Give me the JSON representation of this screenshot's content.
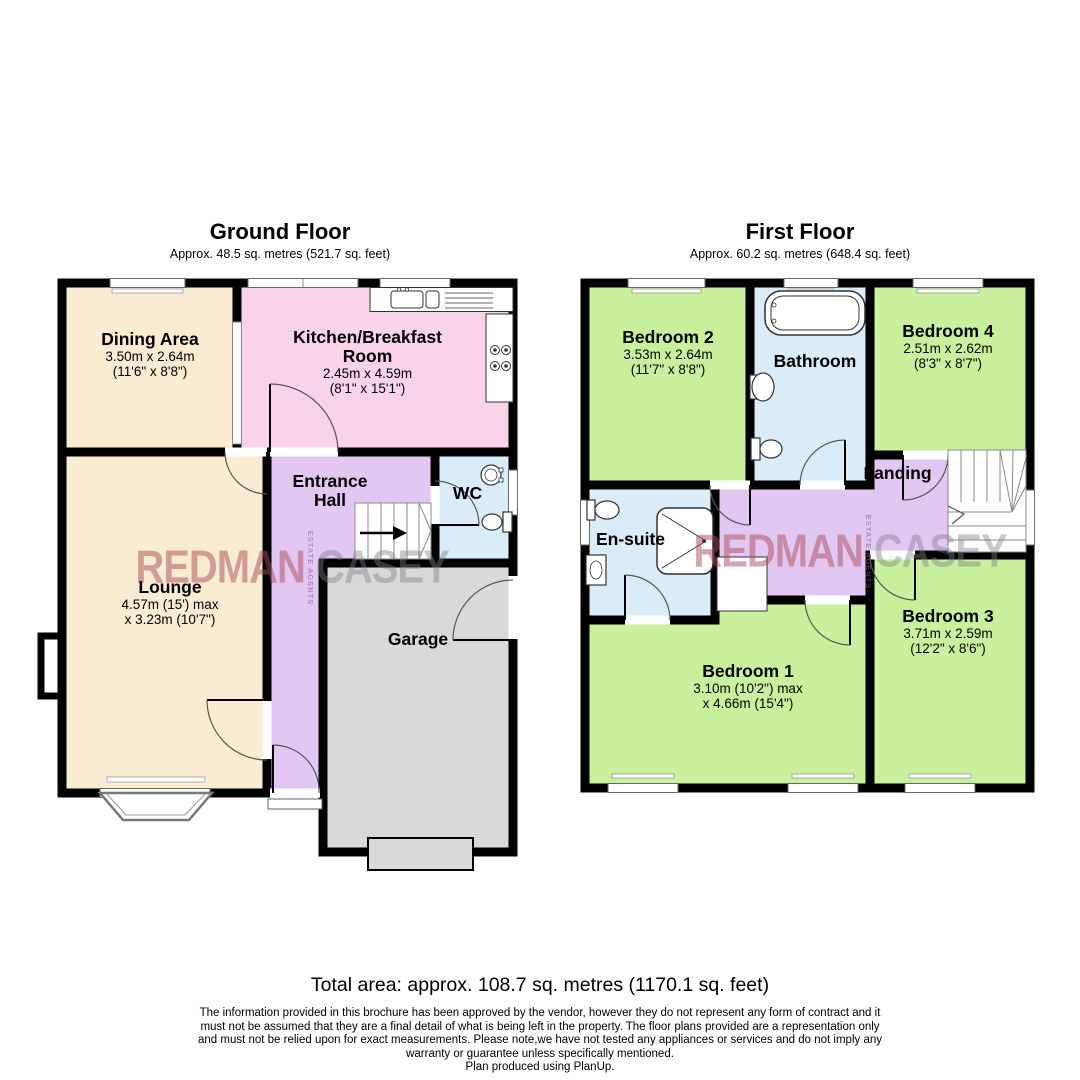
{
  "ground_floor": {
    "title": "Ground Floor",
    "subtitle": "Approx. 48.5 sq. metres (521.7 sq. feet)",
    "rooms": {
      "dining": {
        "name": "Dining Area",
        "dims1": "3.50m x 2.64m",
        "dims2": "(11'6\" x 8'8\")"
      },
      "kitchen": {
        "name": "Kitchen/Breakfast Room",
        "dims1": "2.45m x 4.59m",
        "dims2": "(8'1\" x 15'1\")"
      },
      "lounge": {
        "name": "Lounge",
        "dims1": "4.57m (15') max",
        "dims2": "x 3.23m (10'7\")"
      },
      "hall": {
        "name": "Entrance Hall"
      },
      "wc": {
        "name": "WC"
      },
      "garage": {
        "name": "Garage"
      }
    }
  },
  "first_floor": {
    "title": "First Floor",
    "subtitle": "Approx. 60.2 sq. metres (648.4 sq. feet)",
    "rooms": {
      "bedroom2": {
        "name": "Bedroom 2",
        "dims1": "3.53m x 2.64m",
        "dims2": "(11'7\" x 8'8\")"
      },
      "bathroom": {
        "name": "Bathroom"
      },
      "bedroom4": {
        "name": "Bedroom 4",
        "dims1": "2.51m x 2.62m",
        "dims2": "(8'3\" x 8'7\")"
      },
      "landing": {
        "name": "Landing"
      },
      "ensuite": {
        "name": "En-suite"
      },
      "bedroom1": {
        "name": "Bedroom 1",
        "dims1": "3.10m (10'2\") max",
        "dims2": "x 4.66m (15'4\")"
      },
      "bedroom3": {
        "name": "Bedroom 3",
        "dims1": "3.71m x 2.59m",
        "dims2": "(12'2\" x 8'6\")"
      }
    }
  },
  "watermark": {
    "name1": "REDMAN",
    "tagline": "ESTATE AGENTS",
    "name2": "CASEY"
  },
  "footer": {
    "total_area": "Total area: approx. 108.7 sq. metres (1170.1 sq. feet)",
    "line1": "The information provided in this brochure has been approved by the vendor, however they do not represent any form of contract and it",
    "line2": "must not be assumed that they are a final detail of what is being left in the property. The floor plans provided are a representation only",
    "line3": "and must not be relied upon for exact measurements. Please note,we have not tested any appliances or services and do not imply any",
    "line4": "warranty or guarantee unless specifically mentioned.",
    "line5": "Plan produced using PlanUp."
  },
  "colors": {
    "cream": "#faecd2",
    "pink": "#f8d3ea",
    "purple": "#e2c7f3",
    "blue": "#d9ecf8",
    "green": "#c9f09c",
    "gray": "#d9d9d9",
    "wall": "#000000"
  }
}
